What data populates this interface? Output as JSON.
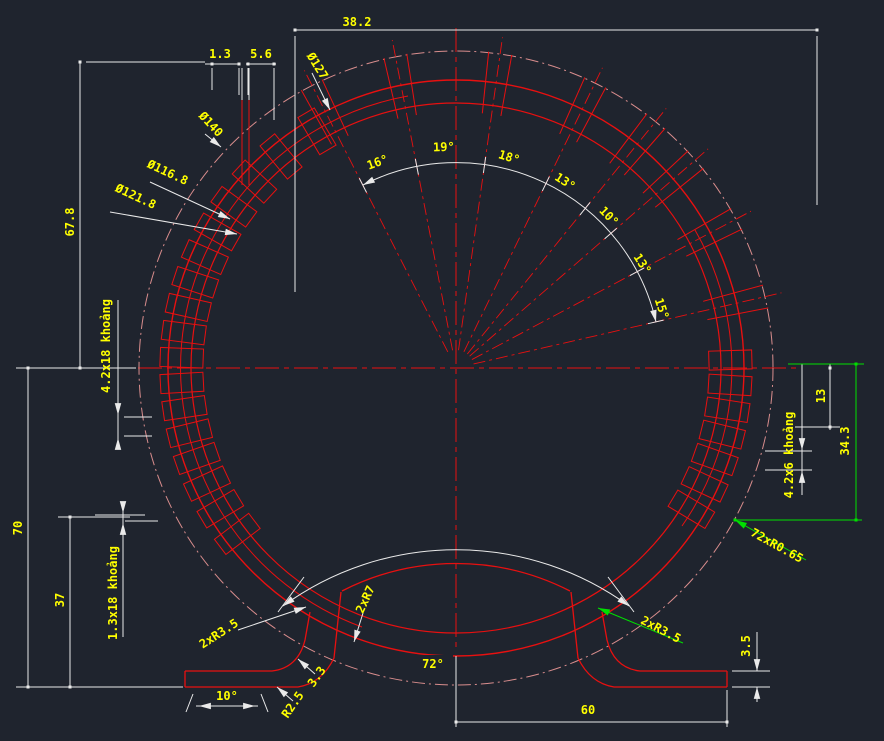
{
  "app": {
    "name": "CAD drawing viewport"
  },
  "colors": {
    "background": "#1f242e",
    "red": "#e81010",
    "centerline_pink": "#d98d8d",
    "white": "#eaeaea",
    "yellow": "#ffff00",
    "green": "#00e000"
  },
  "labels": {
    "d38_2": "38.2",
    "d1_3": "1.3",
    "d5_6": "5.6",
    "dia127": "Ø127",
    "dia140": "Ø140",
    "dia116_8": "Ø116.8",
    "dia121_8": "Ø121.8",
    "d67_8": "67.8",
    "slots_left_pitch": "4.2x18 khoảng",
    "d70": "70",
    "d37": "37",
    "slots_left_gap": "1.3x18 khoảng",
    "a16": "16°",
    "a19": "19°",
    "a18": "18°",
    "a13a": "13°",
    "a10": "10°",
    "a13b": "13°",
    "a15": "15°",
    "d13": "13",
    "slots_right_pitch": "4.2x6 khoảng",
    "d34_3": "34.3",
    "slots_right_r": "72xR0.65",
    "fil_2xr35_left": "2xR3.5",
    "fil_2xr7": "2xR7",
    "a72": "72°",
    "fil_2xr35_right": "2xR3.5",
    "d3_5": "3.5",
    "d60": "60",
    "a10_foot": "10°",
    "r2_5": "R2.5",
    "d3_3": "3.3"
  }
}
